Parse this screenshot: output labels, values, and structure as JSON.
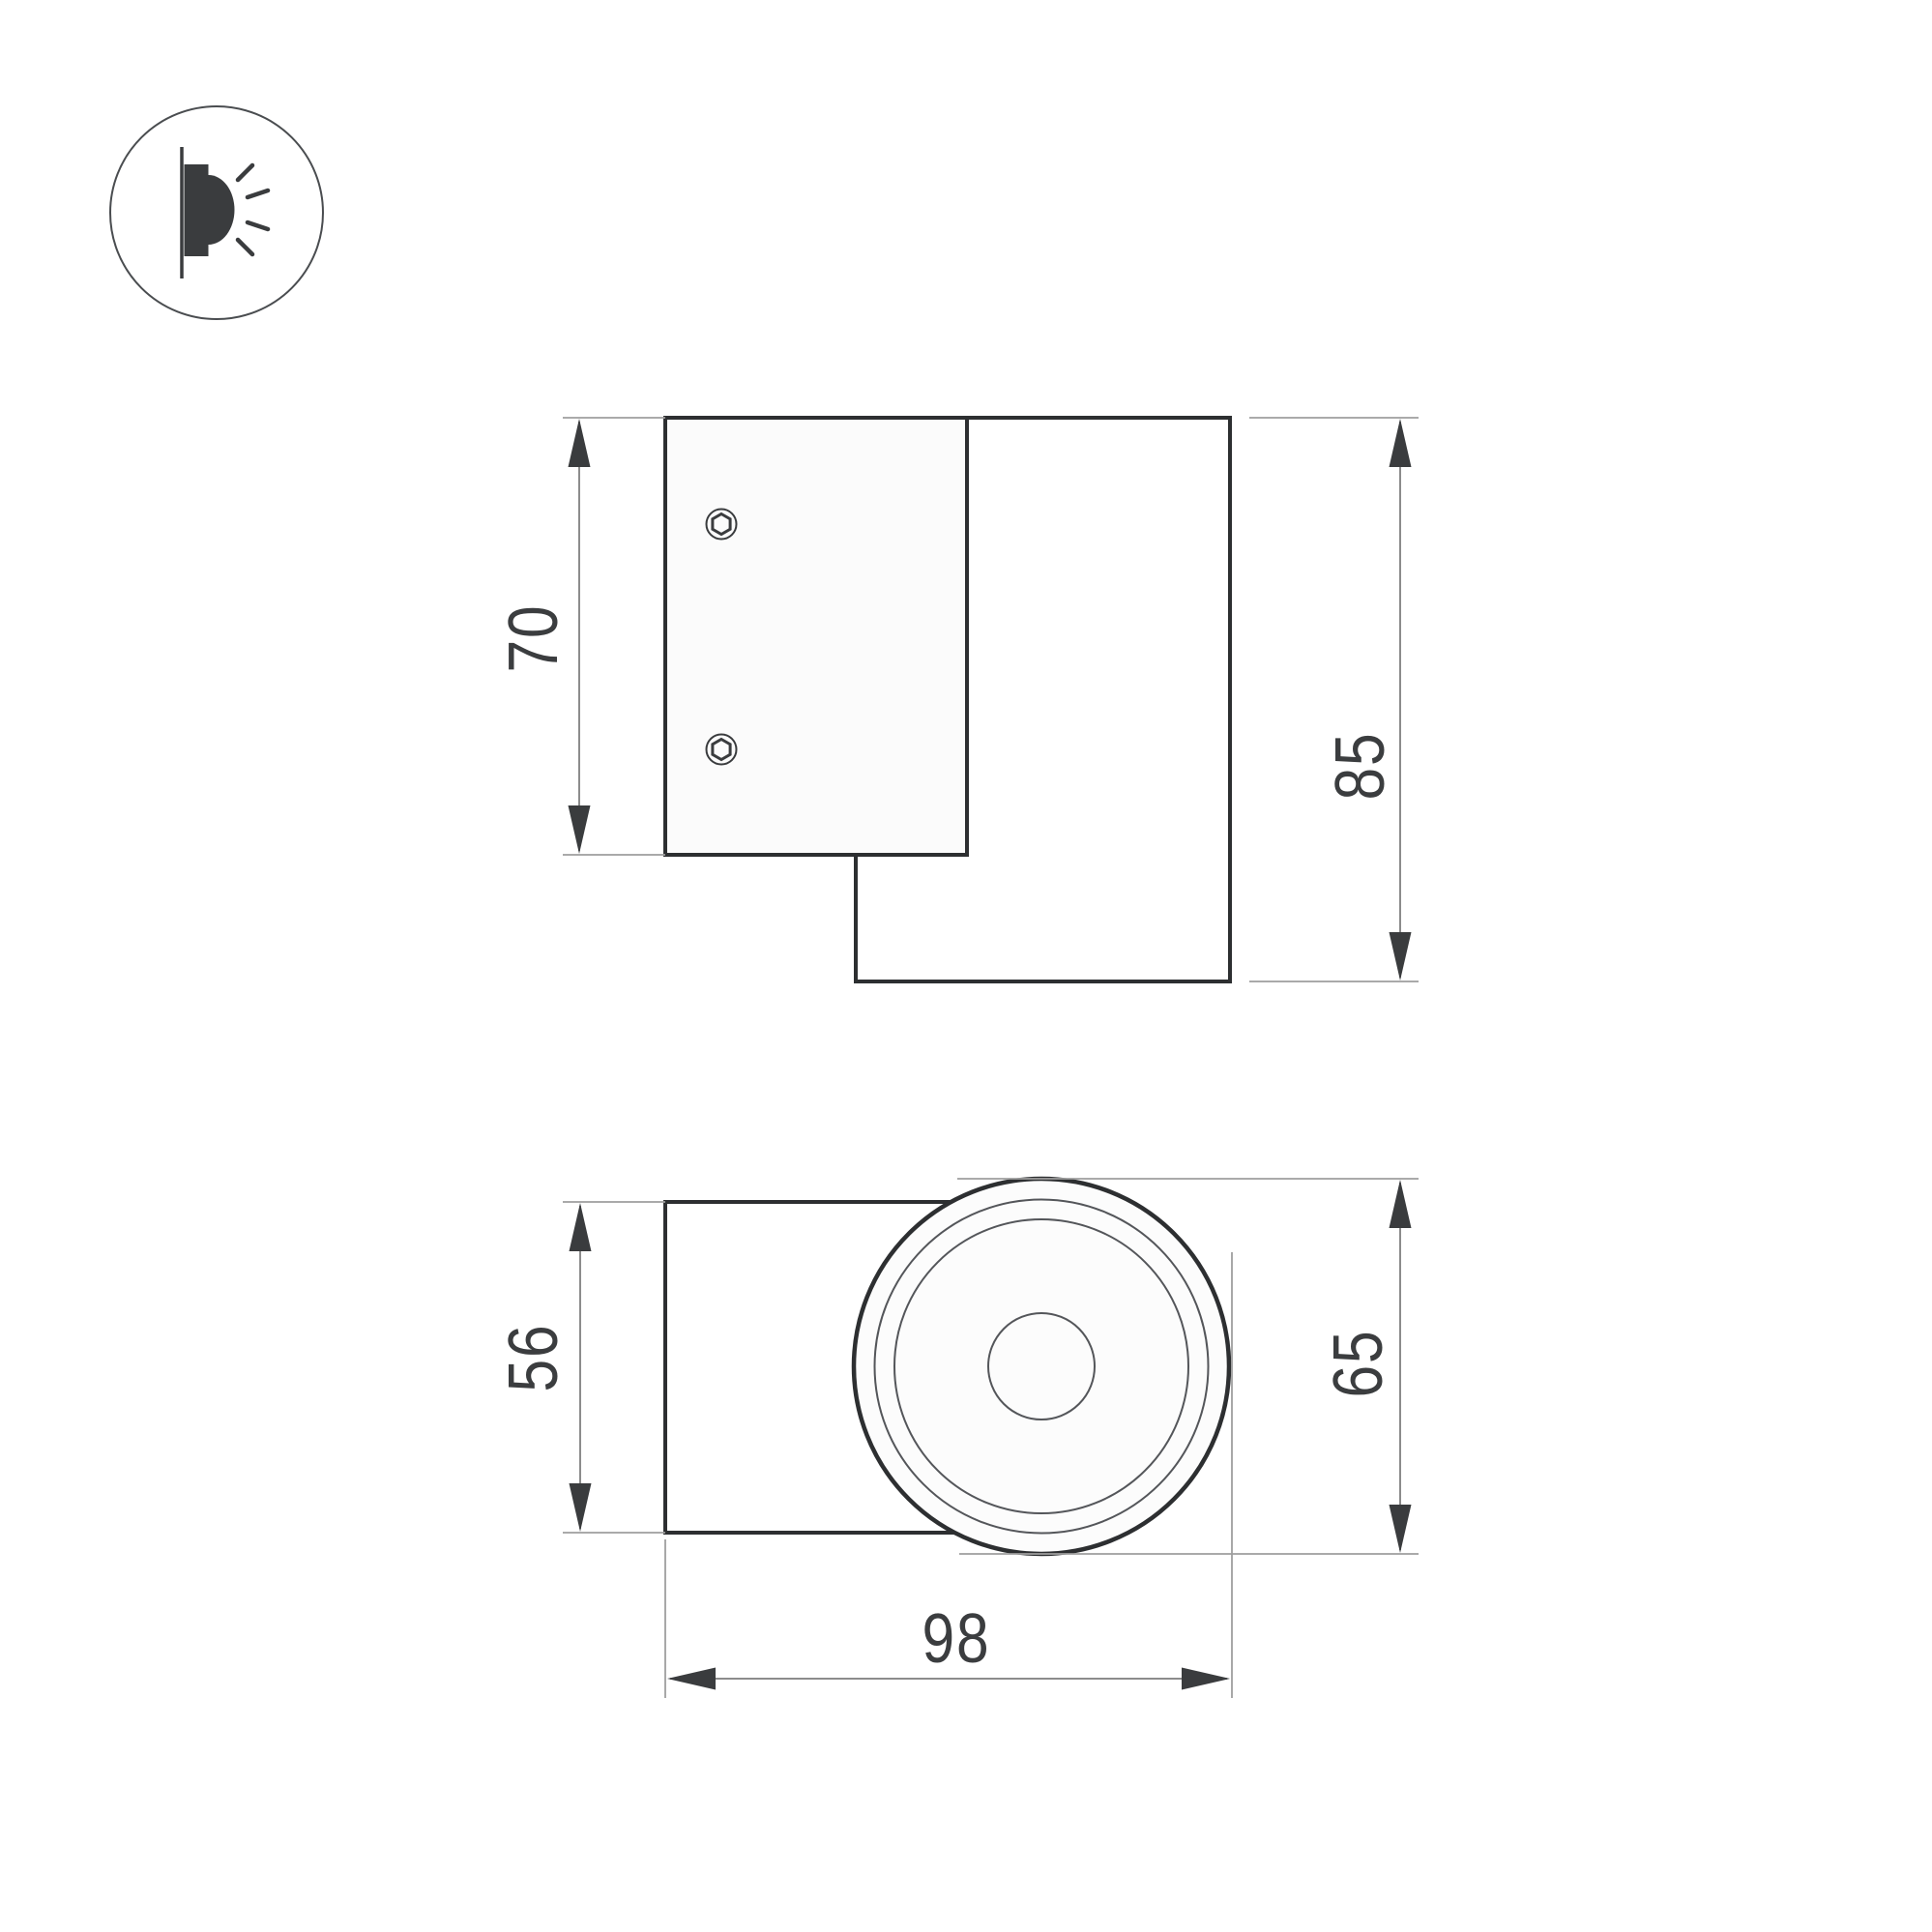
{
  "drawing": {
    "kind": "technical-dimension-drawing",
    "icon": "wall-mounted-light-icon",
    "dimensions": {
      "plate_height": "70",
      "body_height": "85",
      "body_width": "56",
      "face_diameter": "65",
      "overall_depth": "98"
    },
    "colors": {
      "background": "#ffffff",
      "outline": "#2d2f31",
      "thin_line": "#54565a",
      "extension_line": "#9e9e9e",
      "dimension_line": "#8c8c8c",
      "arrow": "#3a3c3e",
      "label_text": "#3b3d3f",
      "plate_fill": "#fbfbfb",
      "face_fill": "#fcfcfc"
    }
  }
}
